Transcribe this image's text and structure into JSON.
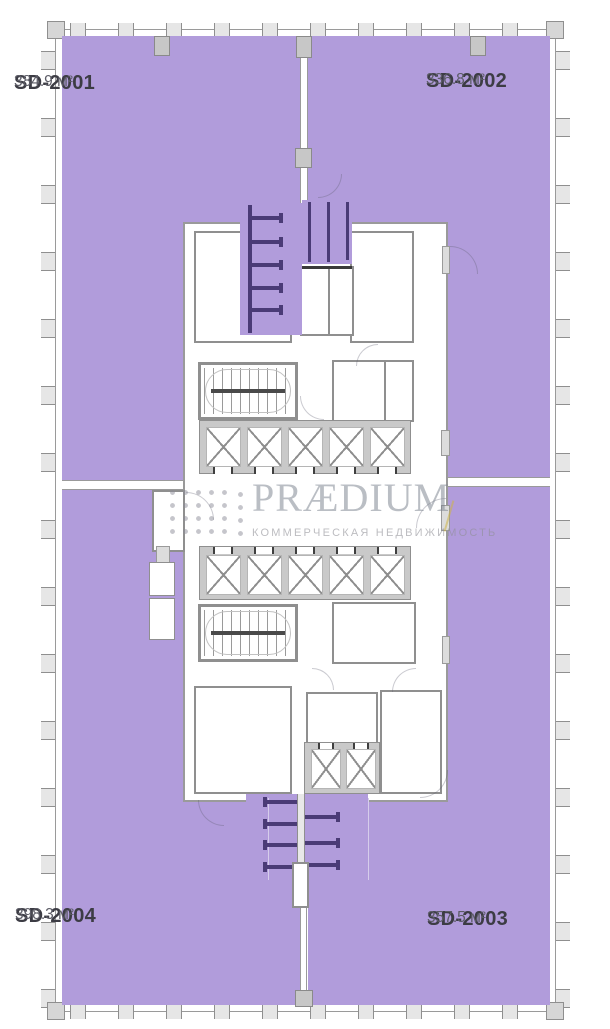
{
  "page": {
    "type": "commercial-floor-plan"
  },
  "plan": {
    "units": [
      {
        "id": "SD-2001",
        "area": "384.9 м²",
        "position": "top-left"
      },
      {
        "id": "SD-2002",
        "area": "336.8 м²",
        "position": "top-right"
      },
      {
        "id": "SD-2003",
        "area": "357.5 м²",
        "position": "bottom-right"
      },
      {
        "id": "SD-2004",
        "area": "398.3 м²",
        "position": "bottom-left"
      }
    ],
    "colors": {
      "unit_fill": "#b19cdb",
      "partition": "#4a3b76",
      "wall_line": "#9a9a9a",
      "watermark_gold": "#cdb446"
    }
  },
  "watermark": {
    "brand": "PRÆDIUM",
    "tagline": "КОММЕРЧЕСКАЯ НЕДВИЖИМОСТЬ",
    "logo": "dot-grid-logo"
  }
}
